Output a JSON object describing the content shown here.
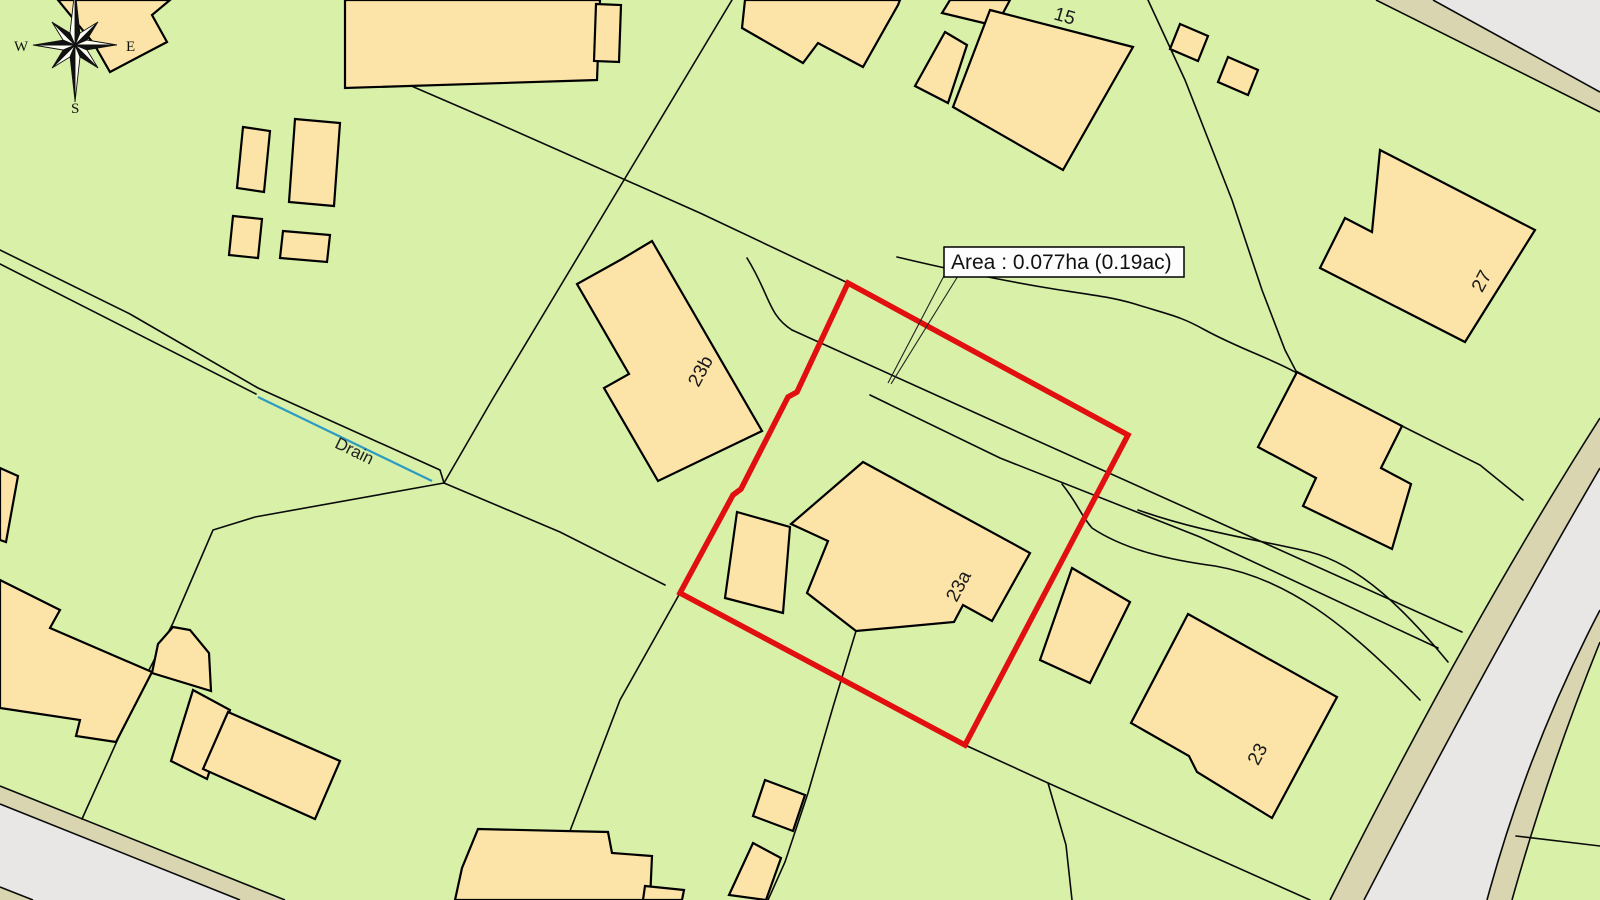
{
  "map": {
    "area_label": "Area : 0.077ha (0.19ac)",
    "drain_label": "Drain",
    "plot_labels": {
      "p15": "15",
      "p27": "27",
      "p23b": "23b",
      "p23a": "23a",
      "p23": "23"
    },
    "compass": {
      "west": "W",
      "east": "E",
      "south": "S"
    },
    "highlight": {
      "area_ha": "0.077",
      "area_ac": "0.19",
      "color": "#e10f0f"
    },
    "colors": {
      "parcel_green": "#d8f0a8",
      "building_fill": "#fce4a8",
      "building_outline": "#000000",
      "road_surface": "#e8e7e5",
      "road_verge": "#d8d5b0",
      "boundary_line": "#0a0a0a",
      "drain_line": "#2e9bc0",
      "label_box_bg": "#fdfdfd",
      "highlight_red": "#e10f0f"
    }
  }
}
